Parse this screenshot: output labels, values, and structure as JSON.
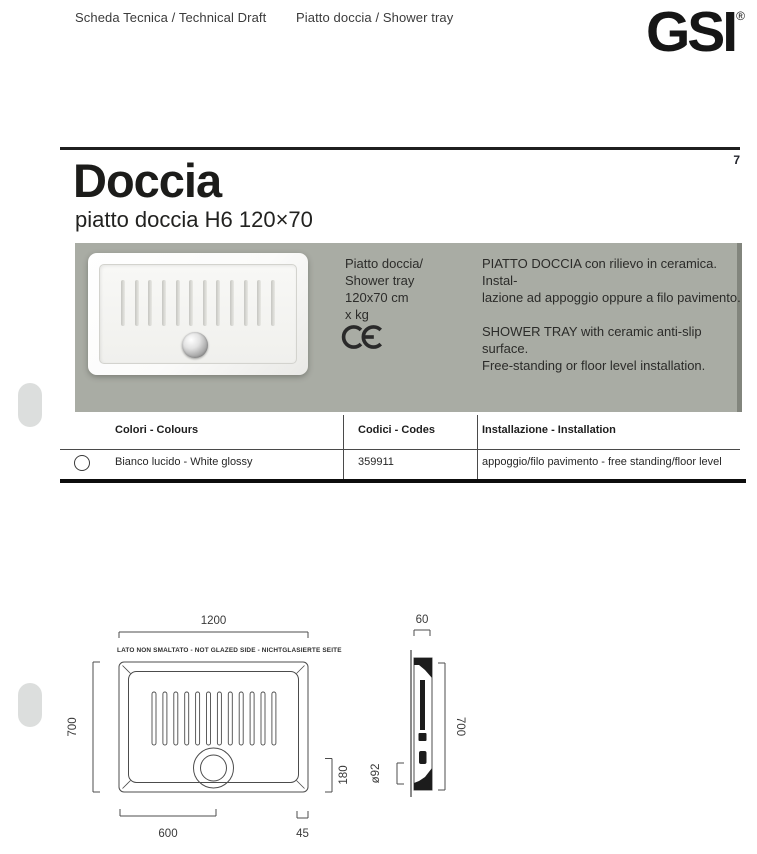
{
  "header": {
    "doc_type": "Scheda Tecnica / Technical Draft",
    "product_type": "Piatto doccia / Shower tray",
    "logo_text": "GSI",
    "registered": "®",
    "page_number": "7"
  },
  "title": {
    "main": "Doccia",
    "subtitle": "piatto doccia H6 120×70"
  },
  "product": {
    "info_lines": [
      "Piatto doccia/",
      "Shower tray",
      "120x70 cm",
      "x kg"
    ],
    "ce_mark": "CE",
    "description_it_lines": [
      "PIATTO DOCCIA con rilievo in ceramica. Instal-",
      "lazione ad appoggio oppure a filo pavimento."
    ],
    "description_en_lines": [
      "SHOWER TRAY with ceramic anti-slip surface.",
      "Free-standing or floor level installation."
    ]
  },
  "table": {
    "columns": [
      "Colori - Colours",
      "Codici - Codes",
      "Installazione - Installation"
    ],
    "rows": [
      {
        "color_name": "Bianco lucido - White glossy",
        "code": "359911",
        "installation": "appoggio/filo pavimento - free standing/floor level",
        "swatch_color": "#ffffff"
      }
    ]
  },
  "drawing": {
    "note": "LATO NON SMALTATO - NOT GLAZED SIDE - NICHTGLASIERTE SEITE",
    "top_width": "1200",
    "top_height": "700",
    "drain_from_left": "600",
    "drain_from_bottom": "180",
    "edge_margin": "45",
    "side_thickness": "60",
    "side_height": "700",
    "drain_diameter": "ø92"
  },
  "colors": {
    "block_gray": "#a9aca4",
    "block_edge_gray": "#82857d",
    "pill_gray": "#dcdedd",
    "rule_black": "#1f1f1f",
    "drawing_stroke": "#4c4c4c"
  }
}
